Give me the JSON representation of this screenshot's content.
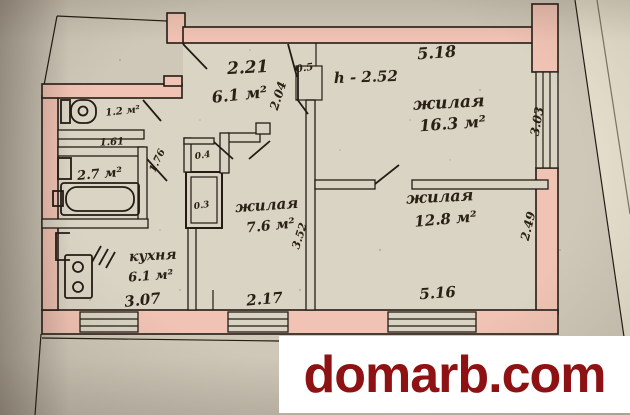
{
  "watermark": {
    "text": "domarb.com",
    "color": "#8e1113",
    "background": "#ffffff"
  },
  "plan": {
    "ceiling_height_note": "h - 2.52",
    "rooms": {
      "hall": {
        "area": "6.1 м²"
      },
      "toilet": {
        "area": "1.2 м²"
      },
      "bathroom": {
        "area": "2.7 м²"
      },
      "kitchen": {
        "name": "кухня",
        "area": "6.1 м²"
      },
      "room_middle": {
        "name": "жилая",
        "area": "7.6 м²"
      },
      "room_top_right": {
        "name": "жилая",
        "area": "16.3 м²"
      },
      "room_bottom_right": {
        "name": "жилая",
        "area": "12.8 м²"
      }
    },
    "dimensions": {
      "hall_width": "2.21",
      "hall_depth": "2.04",
      "niche": "0.5",
      "room_top_right_width": "5.18",
      "room_top_right_depth": "3.03",
      "toilet_width": "1.61",
      "bath_door": "1.76",
      "closet_upper": "0.4",
      "closet_lower": "0.3",
      "room_middle_depth": "3.52",
      "room_middle_width": "2.17",
      "kitchen_width": "3.07",
      "room_bottom_right_width": "5.16",
      "room_bottom_right_depth": "2.49"
    },
    "colors": {
      "paper": "#d9d3c4",
      "wall_fill": "#f0c3b4",
      "ink": "#241c14"
    }
  }
}
